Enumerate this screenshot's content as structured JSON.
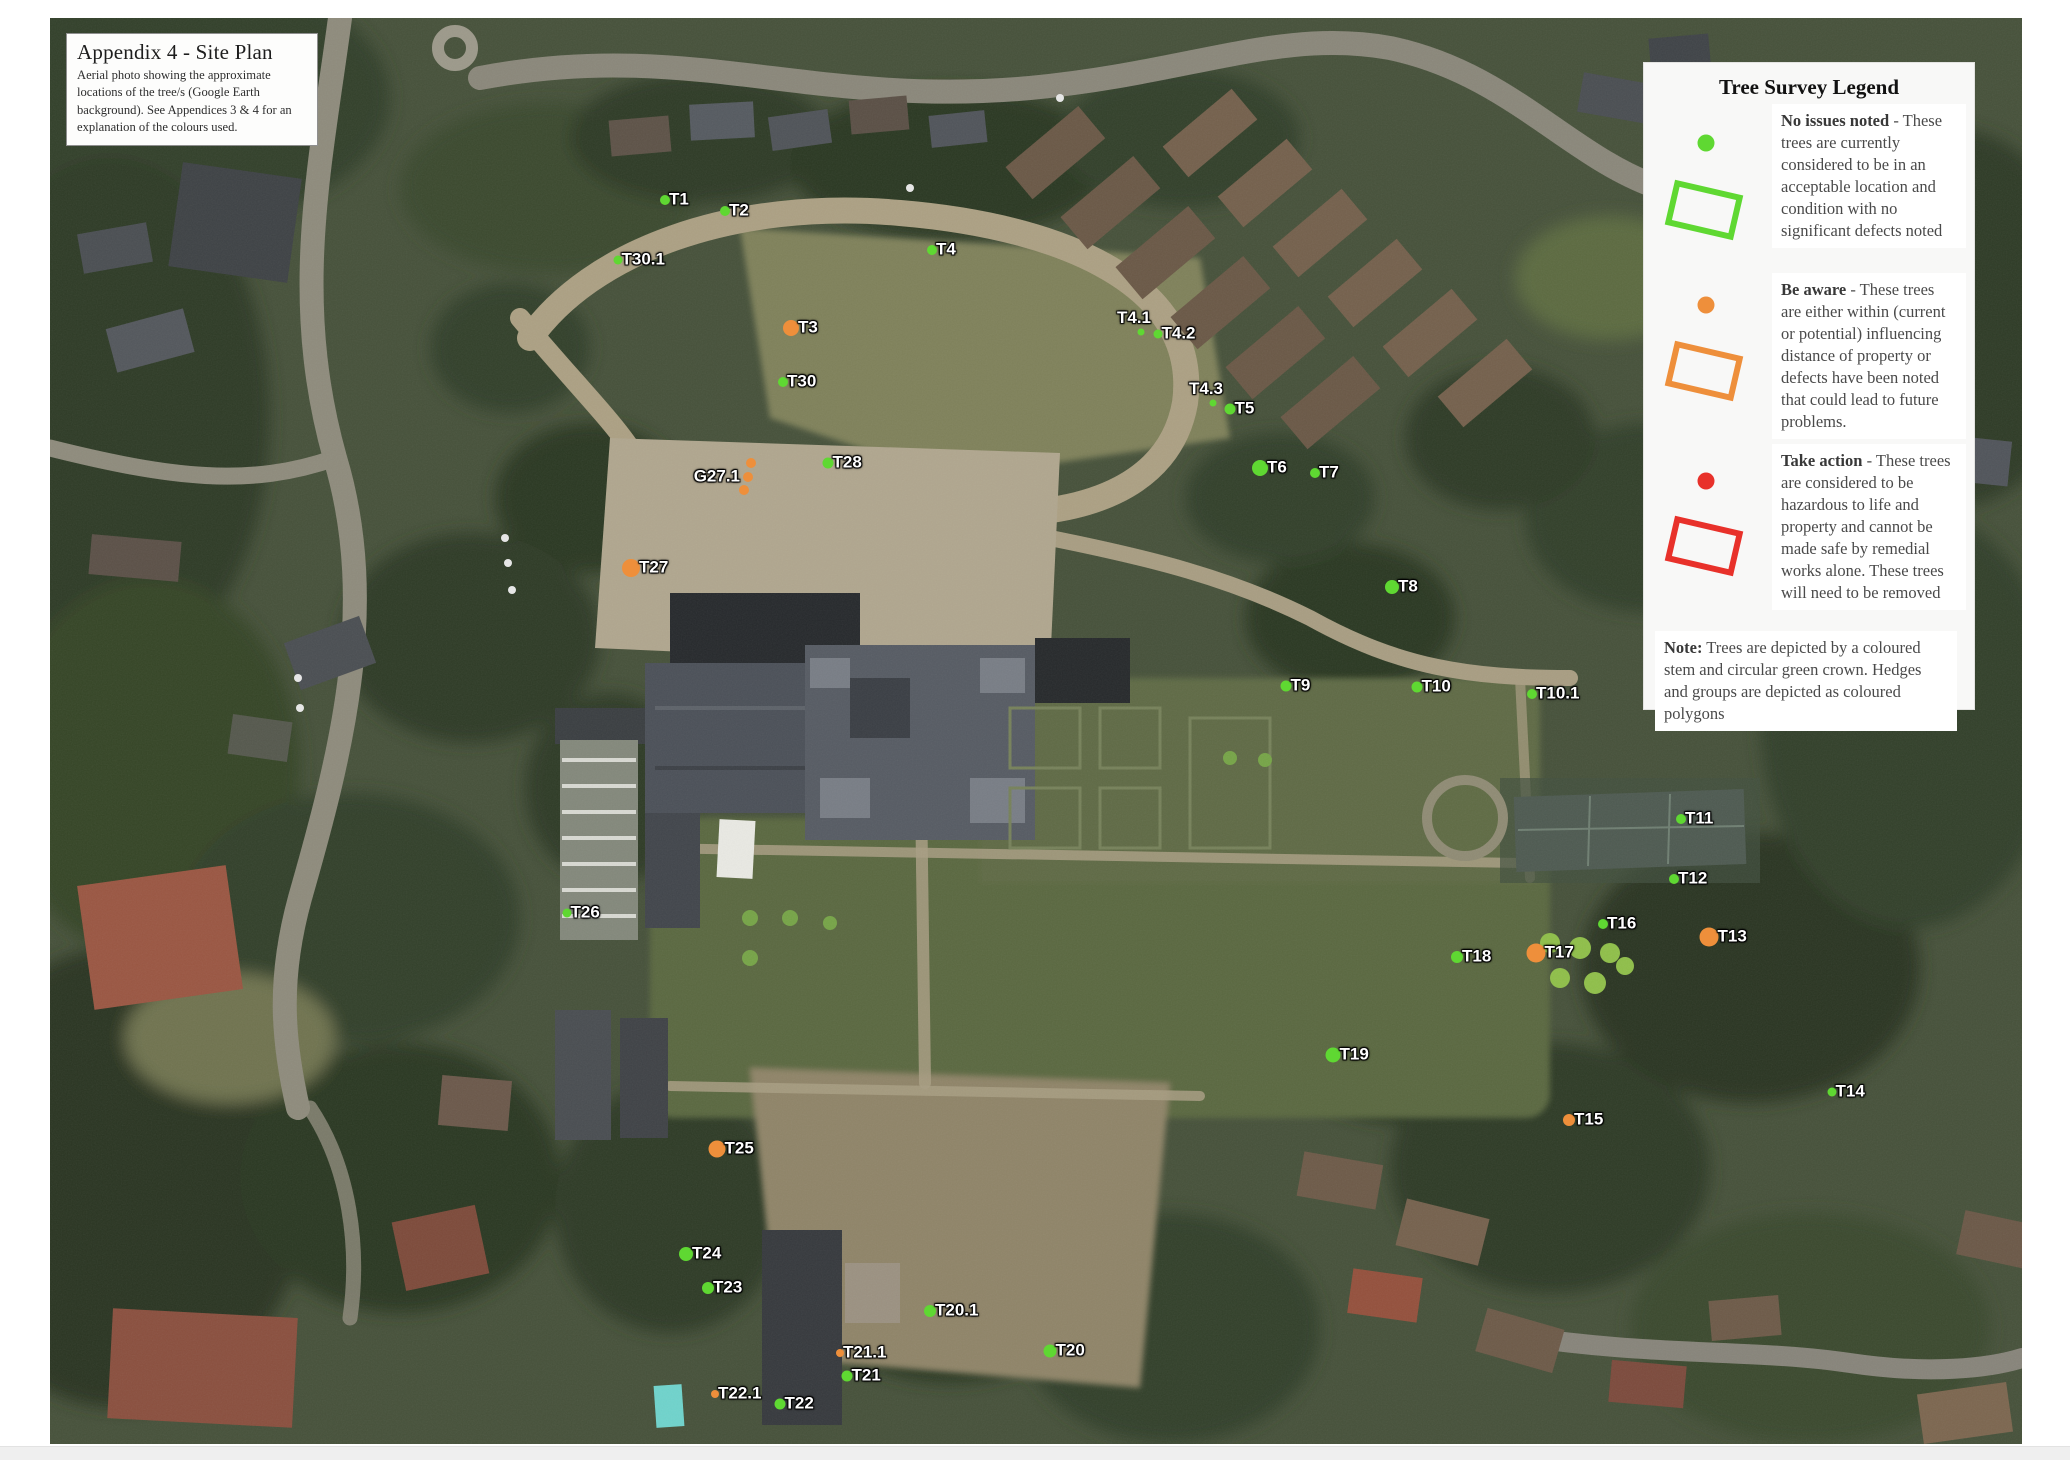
{
  "title_box": {
    "title": "Appendix 4 - Site Plan",
    "body": "Aerial photo showing the approximate locations of the tree/s (Google Earth background).  See Appendices 3 & 4 for an explanation of the colours used."
  },
  "legend": {
    "title": "Tree Survey Legend",
    "entries": [
      {
        "color": "#5fd832",
        "lead": "No issues noted",
        "text": " - These trees are currently considered to be in an acceptable location and condition with no significant defects noted"
      },
      {
        "color": "#ee8f3b",
        "lead": "Be aware",
        "text": " - These trees are either within (current or potential) influencing distance of property or defects have been noted that could lead to future problems."
      },
      {
        "color": "#e8312a",
        "lead": "Take action",
        "text": " - These trees are considered to be hazardous to life and property and cannot be made safe by remedial works alone. These trees will need to be removed"
      }
    ],
    "note_lead": "Note:",
    "note_text": " Trees are depicted by a coloured stem and circular green crown. Hedges and groups are depicted as coloured polygons"
  },
  "colors": {
    "green": "#5fd832",
    "orange": "#ee8f3b",
    "red": "#e8312a"
  },
  "markers": [
    {
      "label": "T1",
      "x": 665,
      "y": 200,
      "color": "green",
      "size": 10,
      "labelPos": "right"
    },
    {
      "label": "T2",
      "x": 725,
      "y": 211,
      "color": "green",
      "size": 10,
      "labelPos": "right"
    },
    {
      "label": "T30.1",
      "x": 618,
      "y": 260,
      "color": "green",
      "size": 9,
      "labelPos": "right"
    },
    {
      "label": "T4",
      "x": 932,
      "y": 250,
      "color": "green",
      "size": 10,
      "labelPos": "right"
    },
    {
      "label": "T3",
      "x": 791,
      "y": 328,
      "color": "orange",
      "size": 16,
      "labelPos": "right"
    },
    {
      "label": "T4.1",
      "x": 1141,
      "y": 332,
      "color": "green",
      "size": 7,
      "labelPos": "above"
    },
    {
      "label": "T4.2",
      "x": 1158,
      "y": 334,
      "color": "green",
      "size": 9,
      "labelPos": "right"
    },
    {
      "label": "T30",
      "x": 783,
      "y": 382,
      "color": "green",
      "size": 10,
      "labelPos": "right"
    },
    {
      "label": "T4.3",
      "x": 1213,
      "y": 403,
      "color": "green",
      "size": 7,
      "labelPos": "above"
    },
    {
      "label": "T5",
      "x": 1230,
      "y": 409,
      "color": "green",
      "size": 11,
      "labelPos": "right"
    },
    {
      "label": "T28",
      "x": 828,
      "y": 463,
      "color": "green",
      "size": 11,
      "labelPos": "right"
    },
    {
      "label": "",
      "x": 751,
      "y": 463,
      "color": "orange",
      "size": 10,
      "labelPos": "right"
    },
    {
      "label": "G27.1",
      "x": 748,
      "y": 477,
      "color": "orange",
      "size": 10,
      "labelPos": "left"
    },
    {
      "label": "",
      "x": 744,
      "y": 490,
      "color": "orange",
      "size": 10,
      "labelPos": "right"
    },
    {
      "label": "T6",
      "x": 1260,
      "y": 468,
      "color": "green",
      "size": 16,
      "labelPos": "right"
    },
    {
      "label": "T7",
      "x": 1315,
      "y": 473,
      "color": "green",
      "size": 10,
      "labelPos": "right"
    },
    {
      "label": "T27",
      "x": 631,
      "y": 568,
      "color": "orange",
      "size": 18,
      "labelPos": "right"
    },
    {
      "label": "T8",
      "x": 1392,
      "y": 587,
      "color": "green",
      "size": 14,
      "labelPos": "right"
    },
    {
      "label": "T9",
      "x": 1286,
      "y": 686,
      "color": "green",
      "size": 11,
      "labelPos": "right"
    },
    {
      "label": "T10",
      "x": 1417,
      "y": 687,
      "color": "green",
      "size": 11,
      "labelPos": "right"
    },
    {
      "label": "T10.1",
      "x": 1532,
      "y": 694,
      "color": "green",
      "size": 10,
      "labelPos": "right"
    },
    {
      "label": "T11",
      "x": 1681,
      "y": 819,
      "color": "green",
      "size": 10,
      "labelPos": "right"
    },
    {
      "label": "T12",
      "x": 1674,
      "y": 879,
      "color": "green",
      "size": 10,
      "labelPos": "right"
    },
    {
      "label": "T26",
      "x": 567,
      "y": 913,
      "color": "green",
      "size": 9,
      "labelPos": "right"
    },
    {
      "label": "T16",
      "x": 1603,
      "y": 924,
      "color": "green",
      "size": 10,
      "labelPos": "right"
    },
    {
      "label": "T13",
      "x": 1709,
      "y": 937,
      "color": "orange",
      "size": 19,
      "labelPos": "right"
    },
    {
      "label": "T17",
      "x": 1536,
      "y": 953,
      "color": "orange",
      "size": 19,
      "labelPos": "right"
    },
    {
      "label": "T18",
      "x": 1457,
      "y": 957,
      "color": "green",
      "size": 12,
      "labelPos": "right"
    },
    {
      "label": "T19",
      "x": 1333,
      "y": 1055,
      "color": "green",
      "size": 15,
      "labelPos": "right"
    },
    {
      "label": "T14",
      "x": 1832,
      "y": 1092,
      "color": "green",
      "size": 9,
      "labelPos": "right"
    },
    {
      "label": "T15",
      "x": 1569,
      "y": 1120,
      "color": "orange",
      "size": 12,
      "labelPos": "right"
    },
    {
      "label": "T25",
      "x": 717,
      "y": 1149,
      "color": "orange",
      "size": 17,
      "labelPos": "right"
    },
    {
      "label": "T24",
      "x": 686,
      "y": 1254,
      "color": "green",
      "size": 14,
      "labelPos": "right"
    },
    {
      "label": "T23",
      "x": 708,
      "y": 1288,
      "color": "green",
      "size": 12,
      "labelPos": "right"
    },
    {
      "label": "T20.1",
      "x": 930,
      "y": 1311,
      "color": "green",
      "size": 12,
      "labelPos": "right"
    },
    {
      "label": "T20",
      "x": 1050,
      "y": 1351,
      "color": "green",
      "size": 13,
      "labelPos": "right"
    },
    {
      "label": "T21.1",
      "x": 840,
      "y": 1353,
      "color": "orange",
      "size": 8,
      "labelPos": "right"
    },
    {
      "label": "T21",
      "x": 847,
      "y": 1376,
      "color": "green",
      "size": 11,
      "labelPos": "right"
    },
    {
      "label": "T22.1",
      "x": 715,
      "y": 1394,
      "color": "orange",
      "size": 8,
      "labelPos": "right"
    },
    {
      "label": "T22",
      "x": 780,
      "y": 1404,
      "color": "green",
      "size": 11,
      "labelPos": "right"
    }
  ]
}
